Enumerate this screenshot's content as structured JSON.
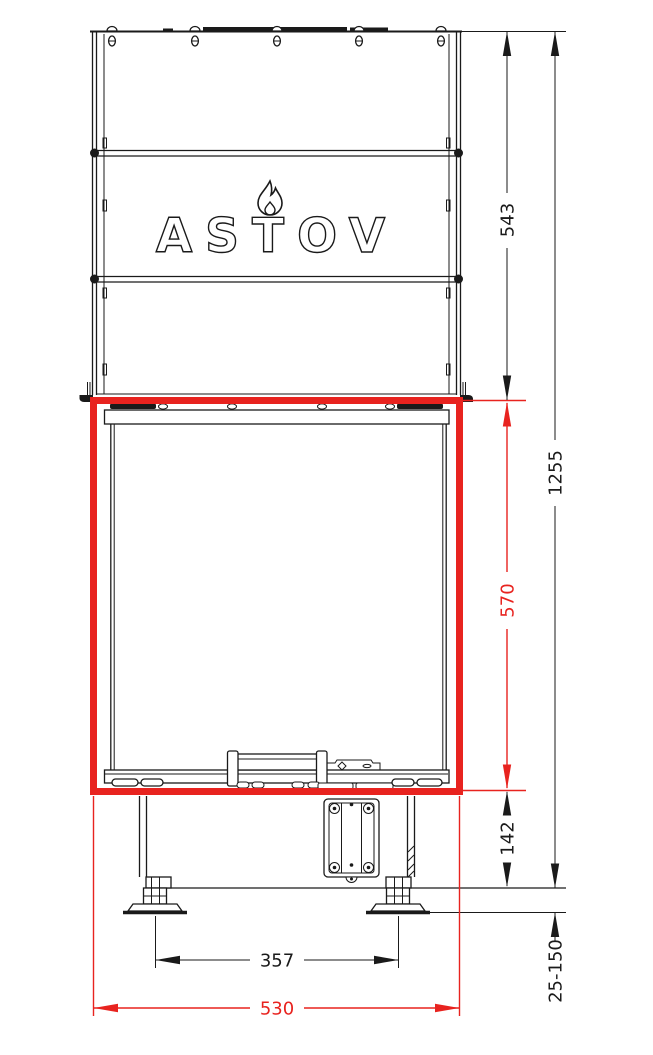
{
  "brand": {
    "logo_text": "ASTOV"
  },
  "colors": {
    "line": "#1a1a1a",
    "highlight_red": "#e8231f",
    "background": "#ffffff"
  },
  "dimensions": {
    "top_section_height": "543",
    "overall_height": "1255",
    "firebox_height": "570",
    "base_section_height": "142",
    "foot_adjustment_range": "25-150",
    "feet_spacing": "357",
    "firebox_width": "530"
  }
}
